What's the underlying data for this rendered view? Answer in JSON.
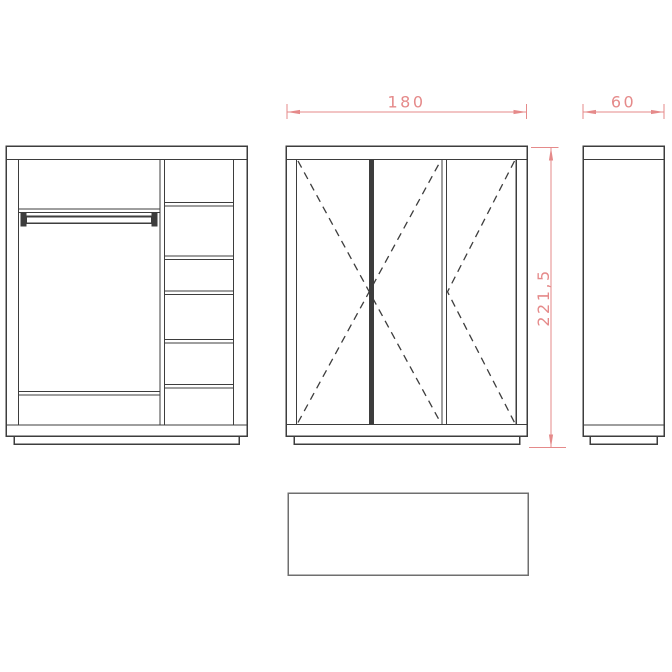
{
  "colors": {
    "dimension": "#e58a8a",
    "line": "#3d3d3d",
    "line_light": "#6f6f6f",
    "background": "#ffffff"
  },
  "dimensions": {
    "width_label": "180",
    "depth_label": "60",
    "height_label": "221,5"
  }
}
